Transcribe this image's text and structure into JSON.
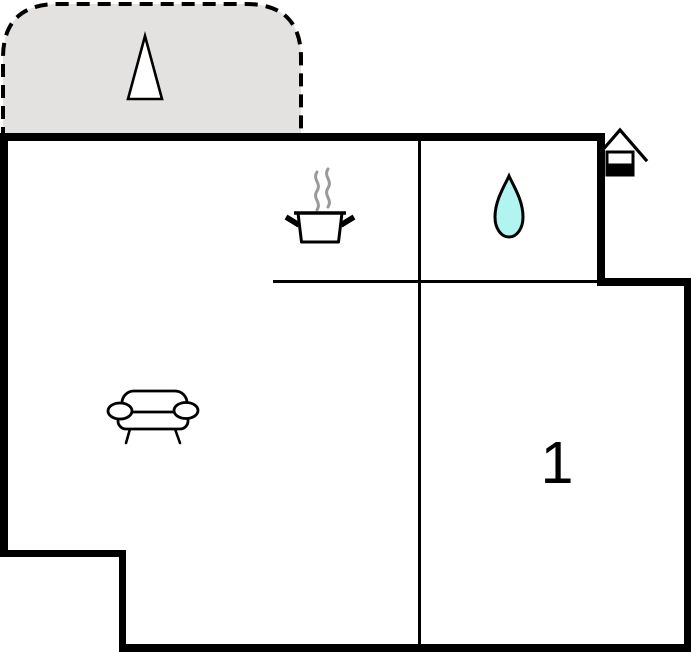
{
  "floorplan": {
    "bedroom": {
      "number": "1"
    },
    "colors": {
      "wall": "#000000",
      "terrace_fill": "#e3e2e0",
      "water_drop_fill": "#b2f4f0",
      "steam": "#9a9a9a"
    },
    "icons": [
      {
        "name": "tree-icon",
        "area": "terrace"
      },
      {
        "name": "cooking-pot-icon",
        "area": "kitchen"
      },
      {
        "name": "water-drop-icon",
        "area": "bathroom"
      },
      {
        "name": "sofa-icon",
        "area": "living-room"
      },
      {
        "name": "entrance-house-icon",
        "area": "entrance"
      }
    ]
  }
}
